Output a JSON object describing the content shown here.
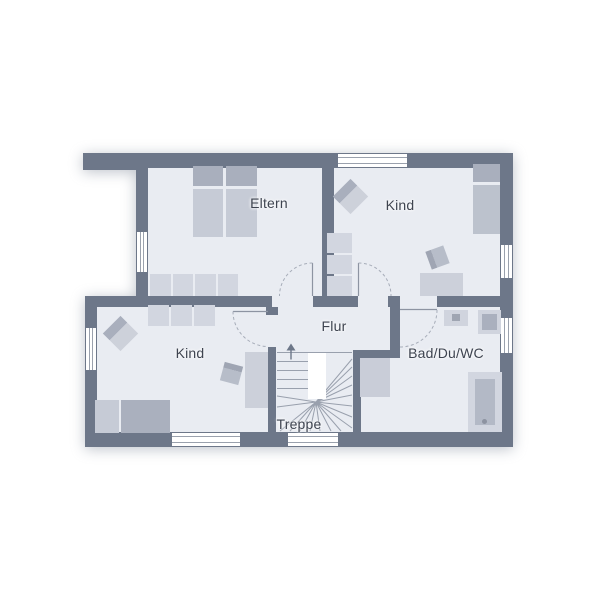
{
  "plan_title": "Obergeschoss Grundriss",
  "rooms": {
    "eltern": {
      "label": "Eltern"
    },
    "kind_top": {
      "label": "Kind"
    },
    "kind_bottom": {
      "label": "Kind"
    },
    "flur": {
      "label": "Flur"
    },
    "treppe": {
      "label": "Treppe"
    },
    "bad": {
      "label": "Bad/Du/WC"
    }
  },
  "colors": {
    "wall": "#6d7789",
    "floor": "#e9ecf2",
    "furniture_light": "#d2d6e0",
    "furniture_mid": "#bcc2cd",
    "furniture_dark": "#a9afbd",
    "line": "#99a0ad",
    "text": "#3e4450",
    "background": "#ffffff"
  }
}
